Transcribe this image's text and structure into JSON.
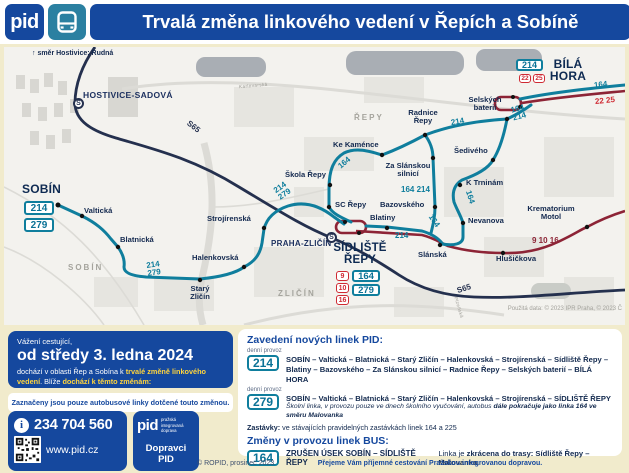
{
  "header": {
    "logo": "pid",
    "title": "Trvalá změna linkového vedení v Řepích a Sobíně"
  },
  "map": {
    "direction_note": "↑ směr Hostivice; Rudná",
    "attribution": "Použitá data: © 2023 IPR Praha, © 2023 Č",
    "stations": {
      "hostivice": "HOSTIVICE-SADOVÁ",
      "zlicin": "PRAHA-ZLIČÍN",
      "s_symbol": "S"
    },
    "terminals": {
      "sobin": "SOBÍN",
      "bila_hora": "BÍLÁ\nHORA",
      "sidliste": "SÍDLIŠTĚ\nŘEPY"
    },
    "areas": {
      "sobin": "SOBÍN",
      "zlicin": "ZLIČÍN",
      "repy": "ŘEPY"
    },
    "streets": {
      "karlovarska": "Karlovarská",
      "plzenska": "Plzeňská"
    },
    "stops": {
      "valticka": "Valtická",
      "blatnicka": "Blatnická",
      "stary_zlicin": "Starý\nZličín",
      "halenkovska": "Halenkovská",
      "strojirenska": "Strojírenská",
      "sc_repy": "SC Řepy",
      "skola_repy": "Škola Řepy",
      "ke_kamence": "Ke Kaménce",
      "radnice_repy": "Radnice\nŘepy",
      "za_slanskou": "Za Slánskou\nsilnicí",
      "bazovskeho": "Bazovského",
      "blatiny": "Blatiny",
      "selskych_baterii": "Selských\nbaterií",
      "sediveho": "Šedivého",
      "k_trninam": "K Trninám",
      "nevanova": "Nevanova",
      "slanska": "Slánská",
      "hlusickova": "Hlušičkova",
      "krematorium_motol": "Krematorium\nMotol"
    },
    "route_labels": {
      "sobin_lines": "214\n279",
      "junction_lines": "214\n279",
      "l164_skola": "164",
      "l164_214_mid": "164 214",
      "l214_radnice": "214",
      "l164_214_bh": "164\n214",
      "l164_east": "164",
      "l22_25": "22 25",
      "l164_trninam": "164",
      "l164_slanska": "164",
      "trams": "9 10 16",
      "l214_corridor": "214",
      "s65_a": "S65",
      "s65_b": "S65"
    },
    "badges": {
      "b214": "214",
      "b279": "279",
      "b164": "164",
      "b9": "9",
      "b10": "10",
      "b16": "16",
      "b22": "22",
      "b25": "25"
    }
  },
  "notice": {
    "greeting": "Vážení cestující,",
    "date": "od středy 3. ledna 2024",
    "body_1": "dochází v oblasti Řep a Sobína k ",
    "body_highlight_1": "trvalé změně linkového vedení",
    "body_2": ". Blíže ",
    "body_highlight_2": "dochází k těmto změnám:"
  },
  "legend_note": "Zaznačeny jsou pouze autobusové linky dotčené touto změnou.",
  "contact": {
    "phone": "234 704 560",
    "web": "www.pid.cz",
    "info_icon": "i"
  },
  "operators": {
    "logo": "pid",
    "logo_sub": "pražská integrovaná\ndoprava",
    "label": "Dopravci PID"
  },
  "changes": {
    "heading_new": "Zavedení nových linek PID:",
    "service_note": "denní provoz",
    "line_214": {
      "number": "214",
      "route": "SOBÍN – Valtická – Blatnická – Starý Zličín – Halenkovská – Strojírenská – Sídliště Řepy – Blatiny – Bazovského – Za Slánskou silnicí – Radnice Řepy – Selských baterií – BÍLÁ HORA"
    },
    "line_279": {
      "number": "279",
      "route": "SOBÍN – Valtická – Blatnická – Starý Zličín – Halenkovská – Strojírenská – SÍDLIŠTĚ ŘEPY",
      "note_regular": "Školní linka, v provozu pouze ve dnech školního vyučování, autobus ",
      "note_bold": "dále pokračuje jako linka 164 ve směru Malovanka"
    },
    "stops_label": "Zastávky:",
    "stops_text": " ve stávajících pravidelných zastávkách linek 164 a 225",
    "heading_bus": "Změny v provozu linek BUS:",
    "line_164": {
      "number": "164",
      "cancelled": "ZRUŠEN ÚSEK SOBÍN – SÍDLIŠTĚ ŘEPY",
      "info_regular": "Linka je ",
      "info_bold": "zkrácena do trasy: Sídliště Řepy – Malovanka",
      "info_suffix": "."
    }
  },
  "footer": {
    "copyright": "© ROPID, prosinec 2023",
    "message": "Přejeme Vám příjemné cestování Pražskou integrovanou dopravou."
  },
  "colors": {
    "pid_blue": "#15489e",
    "bus_teal": "#0f7e9d",
    "tram_red": "#8d2436",
    "badge_red": "#cf2a33",
    "highlight_yellow": "#ffd43d",
    "cream": "#f1ebcc",
    "navy": "#12294e"
  }
}
